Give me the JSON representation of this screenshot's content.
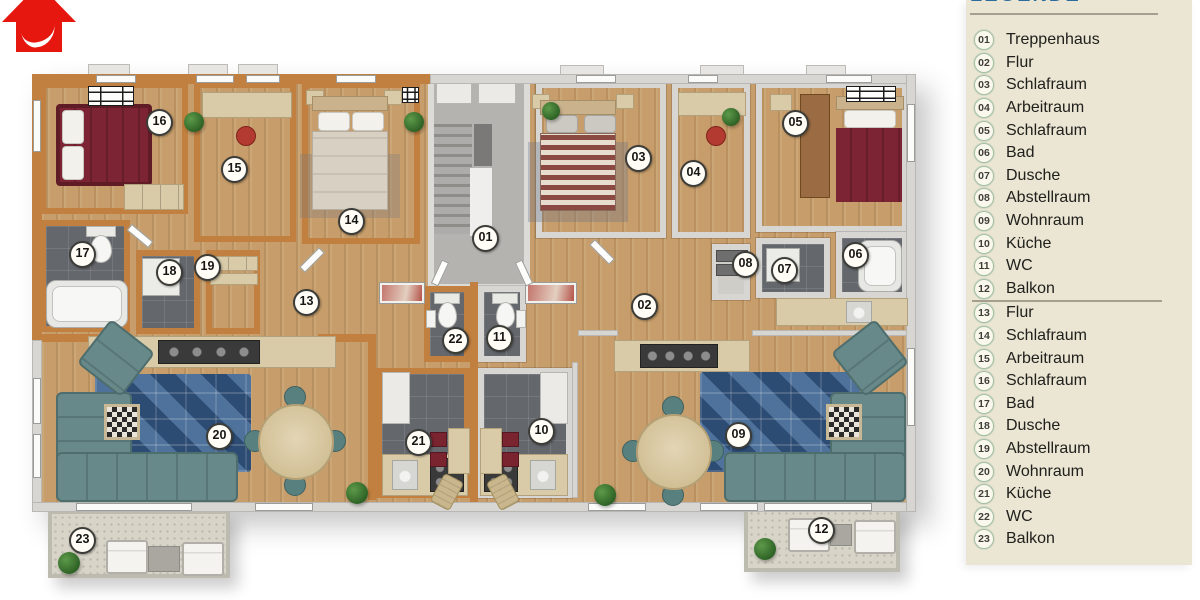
{
  "legend": {
    "title": "LEGENDE",
    "divider_after_index": 11,
    "items": [
      {
        "num": "01",
        "label": "Treppenhaus"
      },
      {
        "num": "02",
        "label": "Flur"
      },
      {
        "num": "03",
        "label": "Schlafraum"
      },
      {
        "num": "04",
        "label": "Arbeitraum"
      },
      {
        "num": "05",
        "label": "Schlafraum"
      },
      {
        "num": "06",
        "label": "Bad"
      },
      {
        "num": "07",
        "label": "Dusche"
      },
      {
        "num": "08",
        "label": "Abstellraum"
      },
      {
        "num": "09",
        "label": "Wohnraum"
      },
      {
        "num": "10",
        "label": "Küche"
      },
      {
        "num": "11",
        "label": "WC"
      },
      {
        "num": "12",
        "label": "Balkon"
      },
      {
        "num": "13",
        "label": "Flur"
      },
      {
        "num": "14",
        "label": "Schlafraum"
      },
      {
        "num": "15",
        "label": "Arbeitraum"
      },
      {
        "num": "16",
        "label": "Schlafraum"
      },
      {
        "num": "17",
        "label": "Bad"
      },
      {
        "num": "18",
        "label": "Dusche"
      },
      {
        "num": "19",
        "label": "Abstellraum"
      },
      {
        "num": "20",
        "label": "Wohnraum"
      },
      {
        "num": "21",
        "label": "Küche"
      },
      {
        "num": "22",
        "label": "WC"
      },
      {
        "num": "23",
        "label": "Balkon"
      }
    ]
  },
  "plan": {
    "badges": [
      {
        "num": "01",
        "x": 484,
        "y": 237
      },
      {
        "num": "02",
        "x": 643,
        "y": 305
      },
      {
        "num": "03",
        "x": 637,
        "y": 157
      },
      {
        "num": "04",
        "x": 692,
        "y": 172
      },
      {
        "num": "05",
        "x": 794,
        "y": 122
      },
      {
        "num": "06",
        "x": 854,
        "y": 254
      },
      {
        "num": "07",
        "x": 783,
        "y": 269
      },
      {
        "num": "08",
        "x": 744,
        "y": 263
      },
      {
        "num": "09",
        "x": 737,
        "y": 434
      },
      {
        "num": "10",
        "x": 540,
        "y": 430
      },
      {
        "num": "11",
        "x": 498,
        "y": 337
      },
      {
        "num": "12",
        "x": 820,
        "y": 529
      },
      {
        "num": "13",
        "x": 305,
        "y": 301
      },
      {
        "num": "14",
        "x": 350,
        "y": 220
      },
      {
        "num": "15",
        "x": 233,
        "y": 168
      },
      {
        "num": "16",
        "x": 158,
        "y": 121
      },
      {
        "num": "17",
        "x": 81,
        "y": 253
      },
      {
        "num": "18",
        "x": 168,
        "y": 271
      },
      {
        "num": "19",
        "x": 206,
        "y": 266
      },
      {
        "num": "20",
        "x": 218,
        "y": 435
      },
      {
        "num": "21",
        "x": 417,
        "y": 441
      },
      {
        "num": "22",
        "x": 454,
        "y": 339
      },
      {
        "num": "23",
        "x": 81,
        "y": 539
      }
    ]
  },
  "icons": {
    "logo": "red-house-with-white-swoosh"
  },
  "colors": {
    "legend_bg": "#ebe5d3",
    "legend_title": "#2b6c9c",
    "badge_ring": "#a3bfa4",
    "logo_red": "#e5170f",
    "wall_orange": "#c28040",
    "wall_light": "#d7d6d2",
    "floor_wood": "#c79e6b",
    "floor_tile": "#64686c",
    "floor_balcony": "#d8d4c8",
    "sofa_teal": "#67898a",
    "rug_blue": "#3a5f8a",
    "bed_red": "#7c2433"
  }
}
